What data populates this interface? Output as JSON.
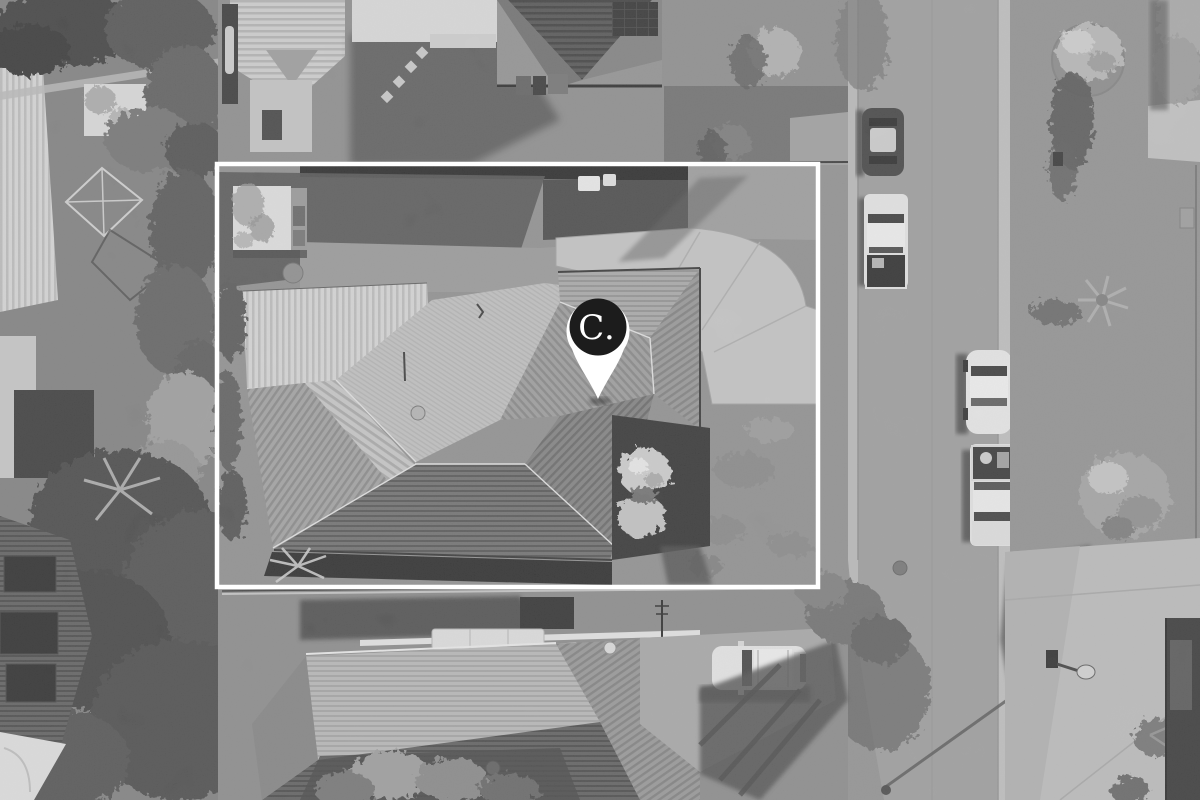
{
  "image": {
    "description": "Black-and-white aerial drone photograph of a suburban residential property",
    "style": "grayscale"
  },
  "overlay": {
    "boundary": {
      "shape": "rectangle",
      "color": "#ffffff"
    },
    "marker": {
      "label": "C.",
      "background": "#1c1c1c",
      "ring": "#ffffff",
      "text_color": "#ffffff"
    }
  },
  "scene": {
    "property": {
      "features": [
        "hip-roof house",
        "corrugated patio roof",
        "garden shed",
        "shaded backyard lawn",
        "curved concrete driveway",
        "front lawn",
        "round shrub",
        "carport shadow"
      ]
    },
    "road": {
      "orientation": "vertical",
      "surface_color": "#9c9c9c"
    },
    "vehicles": [
      {
        "type": "dark hatchback",
        "location": "road left, top"
      },
      {
        "type": "white ute",
        "location": "road left"
      },
      {
        "type": "white sedan",
        "location": "road right"
      },
      {
        "type": "white ute",
        "location": "road right, lower"
      },
      {
        "type": "white suv",
        "location": "bottom driveway"
      }
    ],
    "vegetation": [
      "street tree with shadow",
      "palm tree",
      "hedge top-right",
      "large shrub on verge",
      "dense trees along left boundary",
      "garden shrubs bottom"
    ],
    "neighbors": [
      "house with dark pyramid roof and solar panels (top)",
      "house with solar-panel roof (bottom-left)",
      "tiled hip-roof house (bottom-centre)"
    ]
  }
}
